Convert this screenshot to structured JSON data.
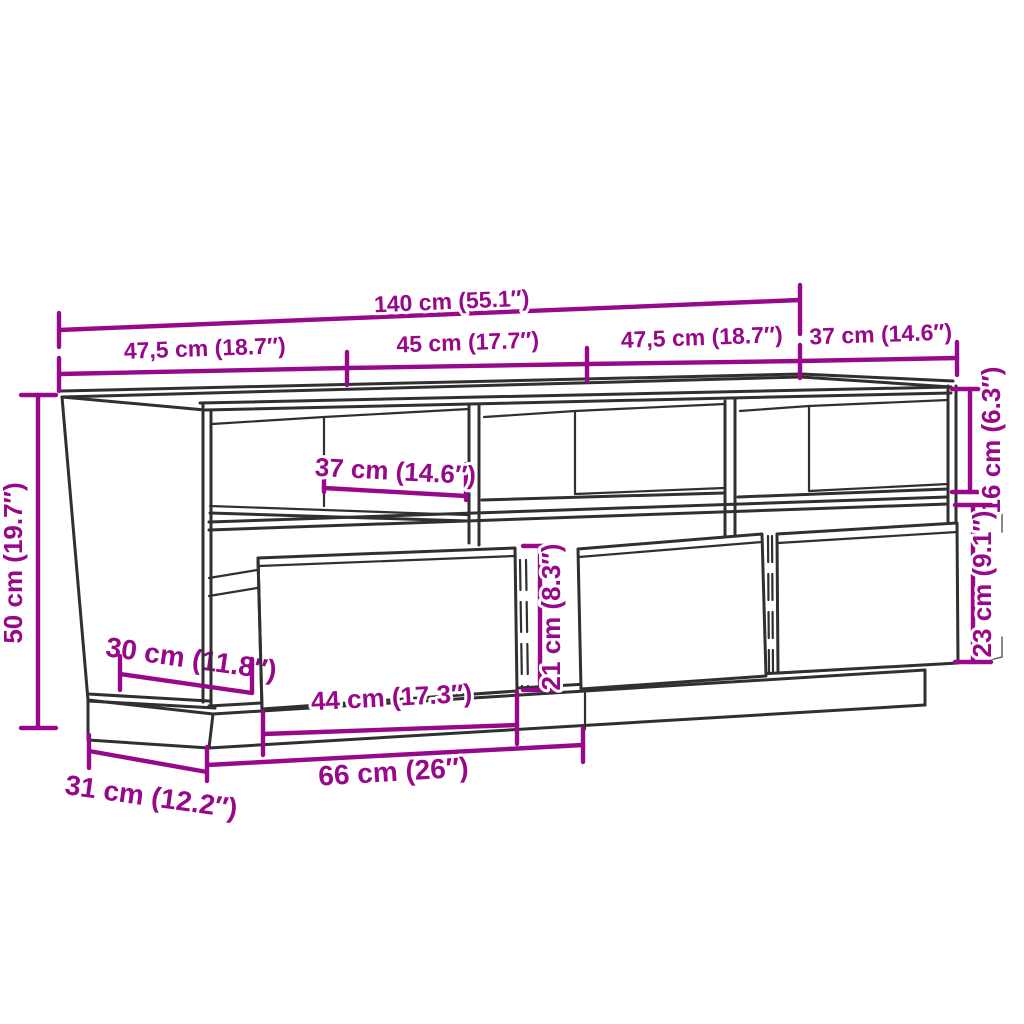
{
  "diagram": {
    "type": "furniture-dimension-diagram",
    "subject": "TV cabinet line drawing with three open shelf compartments, three tilted open drawers and a recessed plinth base",
    "unit_system": "centimeters with inches in parentheses"
  },
  "colors": {
    "dimension": "#97098a",
    "line": "#303030",
    "background": "#ffffff"
  },
  "dimensions": {
    "overall_width": {
      "label": "140 cm (55.1″)",
      "cm": 140,
      "inches": 55.1
    },
    "top_section_left": {
      "label": "47,5 cm (18.7″)",
      "cm": 47.5,
      "inches": 18.7
    },
    "top_section_center": {
      "label": "45 cm (17.7″)",
      "cm": 45,
      "inches": 17.7
    },
    "top_section_right": {
      "label": "47,5 cm (18.7″)",
      "cm": 47.5,
      "inches": 18.7
    },
    "top_depth": {
      "label": "37 cm (14.6″)",
      "cm": 37,
      "inches": 14.6
    },
    "overall_height": {
      "label": "50 cm (19.7″)",
      "cm": 50,
      "inches": 19.7
    },
    "shelf_opening_width": {
      "label": "37 cm (14.6″)",
      "cm": 37,
      "inches": 14.6
    },
    "shelf_opening_height": {
      "label": "16 cm (6.3″)",
      "cm": 16,
      "inches": 6.3
    },
    "drawer_zone_height": {
      "label": "23 cm (9.1″)",
      "cm": 23,
      "inches": 9.1
    },
    "drawer_front_height": {
      "label": "21 cm (8.3″)",
      "cm": 21,
      "inches": 8.3
    },
    "interior_depth": {
      "label": "30 cm (11.8″)",
      "cm": 30,
      "inches": 11.8
    },
    "drawer_front_width": {
      "label": "44 cm (17.3″)",
      "cm": 44,
      "inches": 17.3
    },
    "base_front_width": {
      "label": "66 cm (26″)",
      "cm": 66,
      "inches": 26
    },
    "base_side_depth": {
      "label": "31 cm (12.2″)",
      "cm": 31,
      "inches": 12.2
    }
  }
}
